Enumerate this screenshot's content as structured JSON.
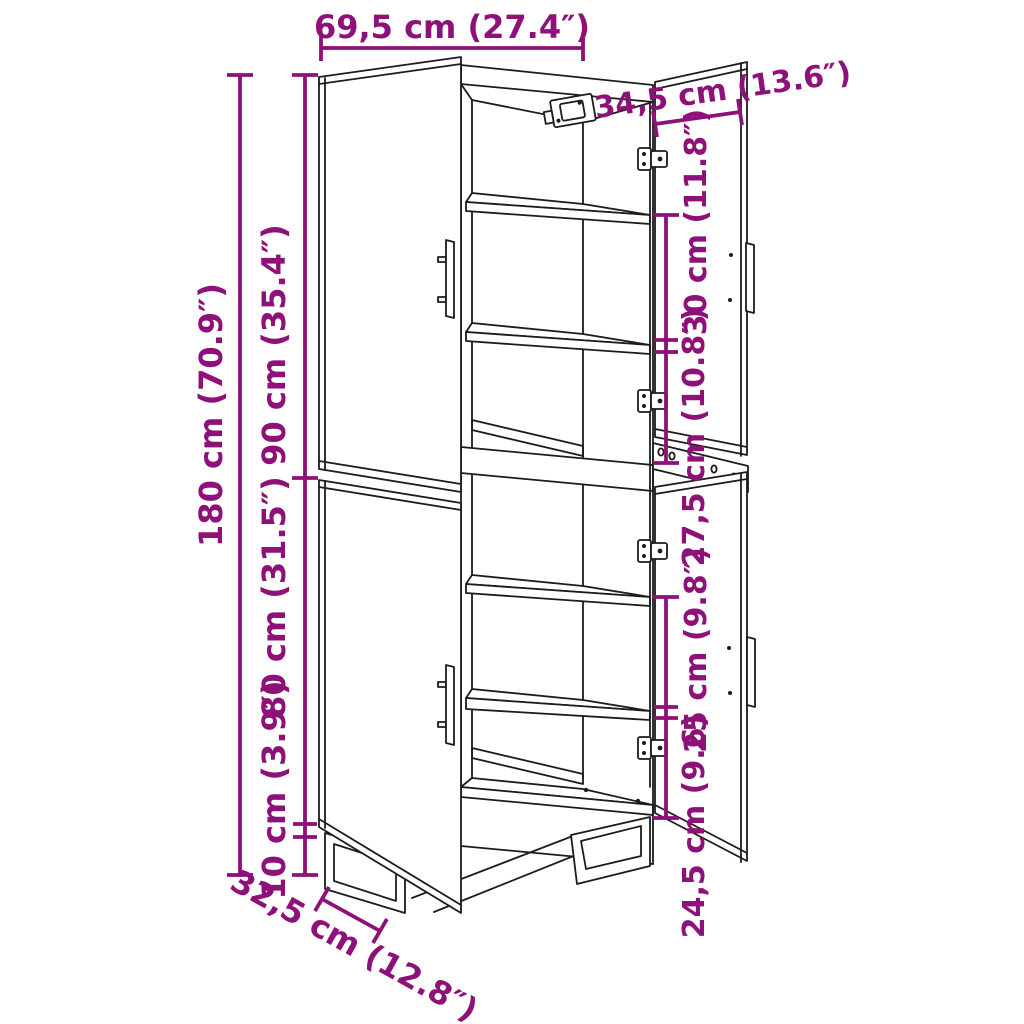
{
  "diagram": {
    "subject": "highboard-cabinet-dimension-drawing",
    "colors": {
      "annotation": "#8D1178",
      "drawing_line": "#1C1C1C",
      "background": "#FFFFFF"
    },
    "dimensions": {
      "overall_width": "69,5 cm (27.4″)",
      "door_width": "34,5 cm (13.6″)",
      "overall_height": "180 cm (70.9″)",
      "upper_section_height": "90 cm (35.4″)",
      "lower_section_height": "80 cm (31.5″)",
      "base_height": "10 cm (3.9″)",
      "compartment_top": "30 cm (11.8″)",
      "compartment_second": "27,5 cm (10.8″)",
      "compartment_third": "25 cm (9.8″)",
      "compartment_bottom": "24,5 cm (9.6)",
      "depth": "32,5 cm (12.8″)"
    }
  }
}
